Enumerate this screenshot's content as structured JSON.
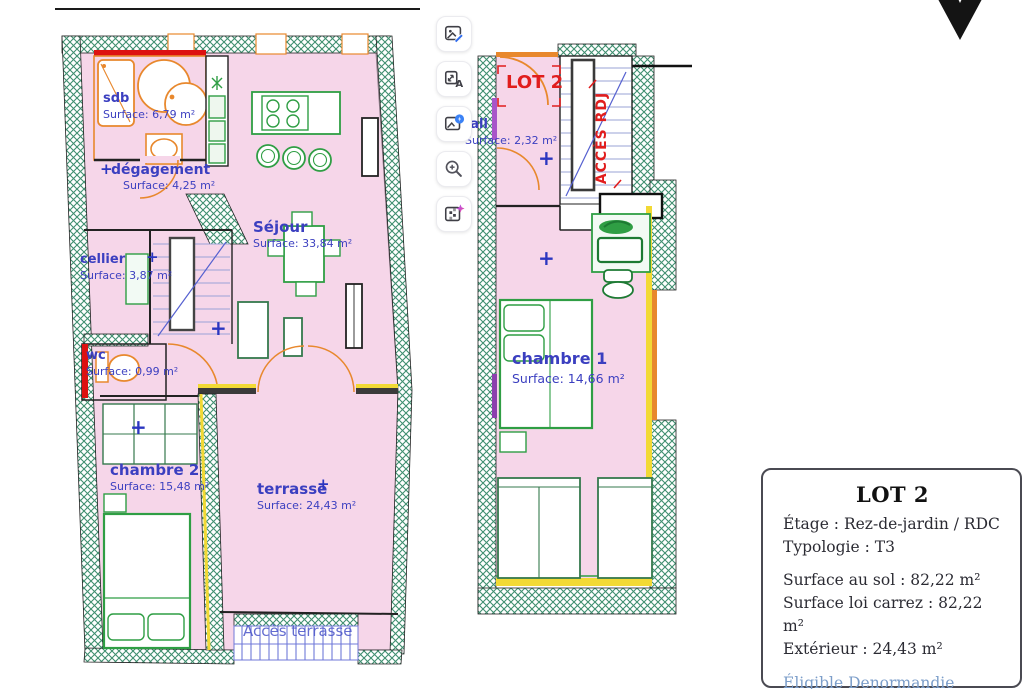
{
  "plans": {
    "plus_symbol": "+",
    "left": {
      "rooms": [
        {
          "name": "sdb",
          "surface": "Surface: 6,79 m²"
        },
        {
          "name": "dégagement",
          "surface": "Surface: 4,25 m²"
        },
        {
          "name": "Séjour",
          "surface": "Surface: 33,84 m²"
        },
        {
          "name": "cellier",
          "surface": "Surface: 3,87 m²"
        },
        {
          "name": "wc",
          "surface": "Surface: 0,99 m²"
        },
        {
          "name": "chambre 2",
          "surface": "Surface: 15,48 m²"
        },
        {
          "name": "terrasse",
          "surface": "Surface: 24,43 m²"
        }
      ],
      "access_label": "Accès terrasse"
    },
    "right": {
      "lot_label": "LOT 2",
      "stair_label": "ACCÈS RDJ",
      "rooms": [
        {
          "name": "hall",
          "surface": "Surface: 2,32 m²"
        },
        {
          "name": "chambre 1",
          "surface": "Surface: 14,66 m²"
        }
      ]
    }
  },
  "toolbar": {
    "buttons": [
      {
        "icon": "image-edit-icon"
      },
      {
        "icon": "image-text-icon"
      },
      {
        "icon": "image-enhance-icon"
      },
      {
        "icon": "zoom-in-icon"
      },
      {
        "icon": "image-pixelate-icon"
      }
    ],
    "letter_a": "A"
  },
  "lot_card": {
    "title": "LOT 2",
    "rows": [
      "Étage : Rez-de-jardin / RDC",
      "Typologie : T3",
      "Surface au sol : 82,22 m²",
      "Surface loi carrez : 82,22 m²",
      "Extérieur : 24,43 m²"
    ],
    "links": [
      "Éligible Denormandie",
      "Éligible déficit foncier"
    ]
  },
  "colors": {
    "room_fill": "#f6d6e9",
    "wall_hatch_green": "#3f8f70",
    "label_blue": "#3b3fc0",
    "annotation_red": "#e11d1d",
    "fixture_orange": "#e8882d",
    "furniture_green": "#2f9e44",
    "wall_yellow": "#f2d935",
    "link_blue": "#7b9dc9"
  }
}
